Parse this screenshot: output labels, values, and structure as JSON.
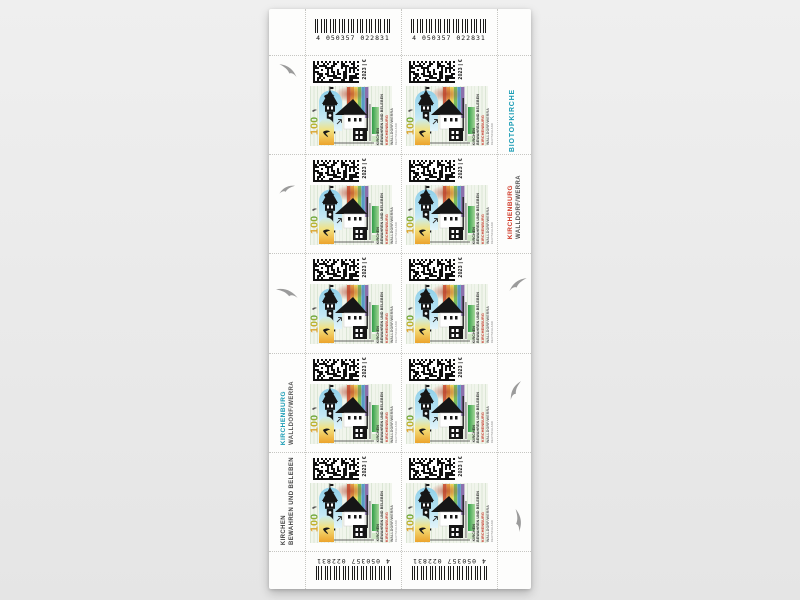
{
  "page": {
    "background": "#ebebeb"
  },
  "sheet": {
    "ean_code": "4 050357 022831"
  },
  "margin_right": {
    "biotopkirche_label": "BIOTOPKIRCHE",
    "kirchenburg_label": "KIRCHENBURG",
    "walldorf_label": "WALLDORF/WERRA"
  },
  "margin_left": {
    "kirchenburg_label": "KIRCHENBURG",
    "walldorf_label": "WALLDORF/WERRA",
    "kirchen_label": "KIRCHEN",
    "bewahren_label": "BEWAHREN UND BELEBEN"
  },
  "stamp": {
    "count": 10,
    "year_currency_label": "2023 | €",
    "face_value": "100",
    "title_line1": "KIRCHEN",
    "title_line2": "BEWAHREN UND BELEBEN",
    "title_line3": "KIRCHENBURG",
    "title_line4": "WALLDORF/WERRA",
    "country_label": "DEUTSCHLAND"
  },
  "colors": {
    "teal_accent": "#1b9cb5",
    "red_accent": "#cf3a28",
    "green_bar": "#2f9e47",
    "value_orange": "#e99b27",
    "value_green": "#57a33b",
    "window_blue": "#8ecfe9",
    "window_warm": "#eca32b"
  }
}
